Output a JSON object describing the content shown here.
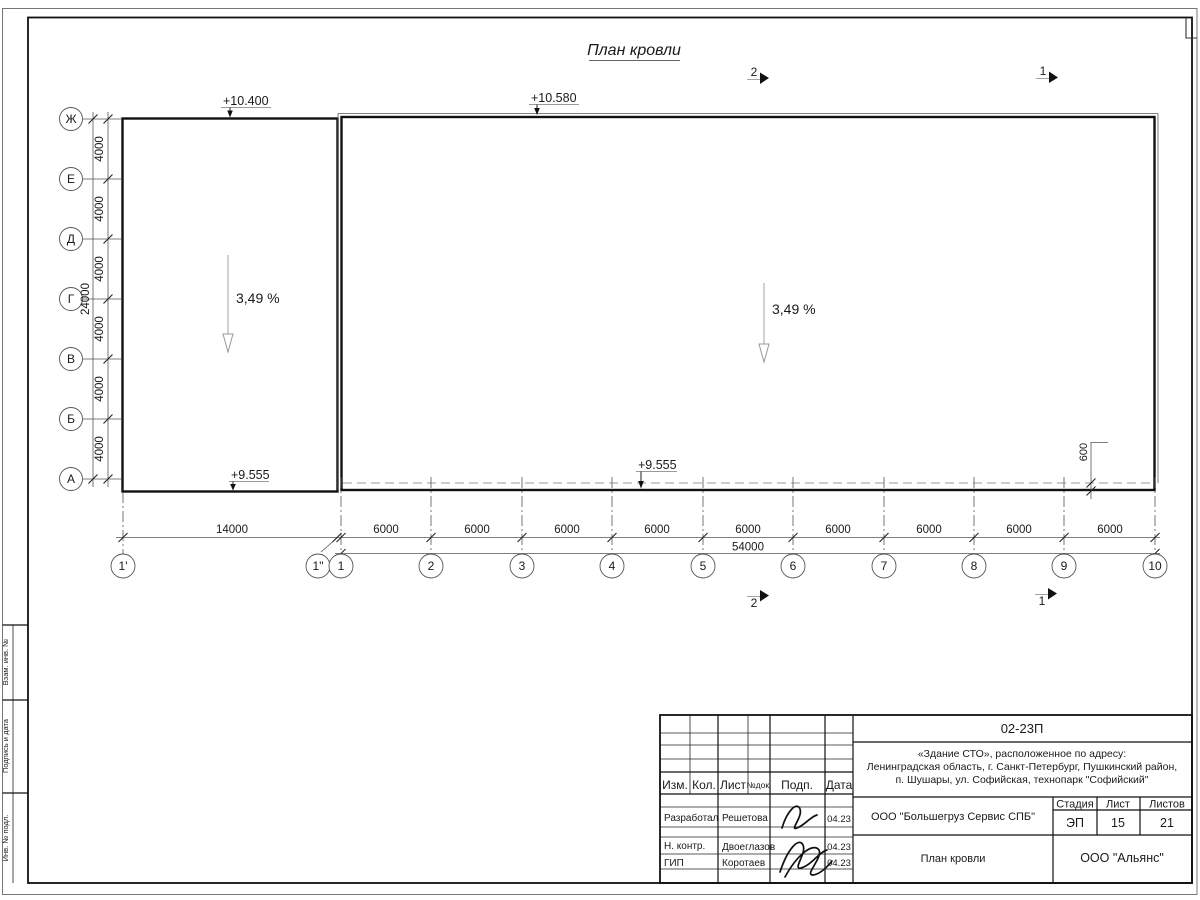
{
  "drawing": {
    "title": "План кровли",
    "elevations": {
      "left_top": "+10.400",
      "right_top": "+10.580",
      "left_bottom": "+9.555",
      "right_bottom": "+9.555"
    },
    "slopes": {
      "left": "3,49 %",
      "right": "3,49 %"
    },
    "offset_dim": "600",
    "sections": {
      "top_left": "2",
      "top_right": "1",
      "bottom_left": "2",
      "bottom_right": "1"
    },
    "axes_left": {
      "labels": [
        "Ж",
        "Е",
        "Д",
        "Г",
        "В",
        "Б",
        "А"
      ],
      "spacing": [
        "4000",
        "4000",
        "4000",
        "4000",
        "4000",
        "4000"
      ],
      "total": "24000"
    },
    "axes_bottom": {
      "labels": [
        "1'",
        "1\"",
        "1",
        "2",
        "3",
        "4",
        "5",
        "6",
        "7",
        "8",
        "9",
        "10"
      ],
      "dims": [
        "14000",
        "6000",
        "6000",
        "6000",
        "6000",
        "6000",
        "6000",
        "6000",
        "6000",
        "6000"
      ],
      "total": "54000"
    }
  },
  "side_stamp": {
    "sections": [
      "Взам. инв. №",
      "Подпись и дата",
      "Инв. № подл."
    ]
  },
  "title_block": {
    "doc_number": "02-23П",
    "address_lines": [
      "«Здание СТО», расположенное по адресу:",
      "Ленинградская область, г. Санкт-Петербург, Пушкинский район,",
      "п. Шушары, ул. Софийская, технопарк \"Софийский\""
    ],
    "header_cols": [
      "Изм.",
      "Кол.",
      "Лист",
      "№док.",
      "Подп.",
      "Дата"
    ],
    "rows": [
      {
        "role": "Разработал",
        "name": "Решетова",
        "date": "04.23"
      },
      {
        "role": "Н. контр.",
        "name": "Двоеглазов",
        "date": "04.23"
      },
      {
        "role": "ГИП",
        "name": "Коротаев",
        "date": "04.23"
      }
    ],
    "org": "ООО \"Большегруз Сервис СПБ\"",
    "stage_label": "Стадия",
    "sheet_label": "Лист",
    "sheets_label": "Листов",
    "stage": "ЭП",
    "sheet": "15",
    "sheets": "21",
    "sheet_title": "План кровли",
    "company": "ООО \"Альянс\""
  }
}
